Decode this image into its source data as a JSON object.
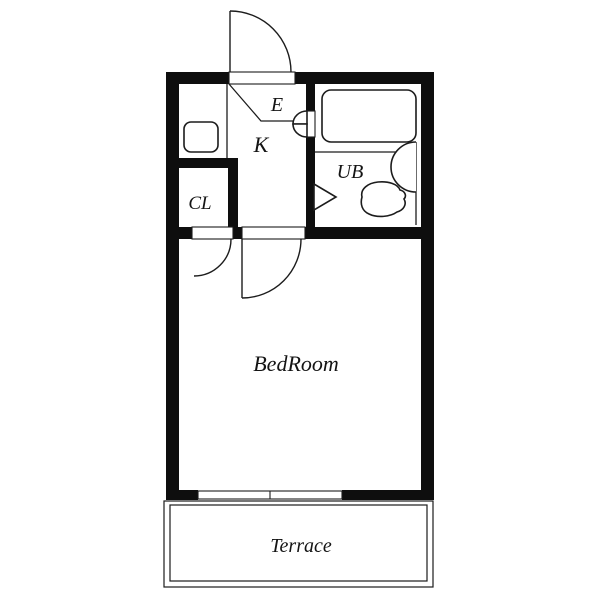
{
  "floor_plan": {
    "title": "apartment-floor-plan",
    "rooms": {
      "entrance": {
        "label": "E"
      },
      "kitchen": {
        "label": "K"
      },
      "unit_bath": {
        "label": "UB"
      },
      "closet": {
        "label": "CL"
      },
      "bedroom": {
        "label": "BedRoom"
      },
      "terrace": {
        "label": "Terrace"
      }
    },
    "fixtures": [
      "entrance-door-swing",
      "unit-bath-folding-door",
      "bathtub",
      "washbasin",
      "toilet",
      "kitchen-sink",
      "closet-door-swing",
      "room-door-swing",
      "sliding-door",
      "genkan-step-line"
    ],
    "colors": {
      "wall": "#0e0e0e",
      "line": "#1c1c1c",
      "background": "#ffffff"
    }
  }
}
